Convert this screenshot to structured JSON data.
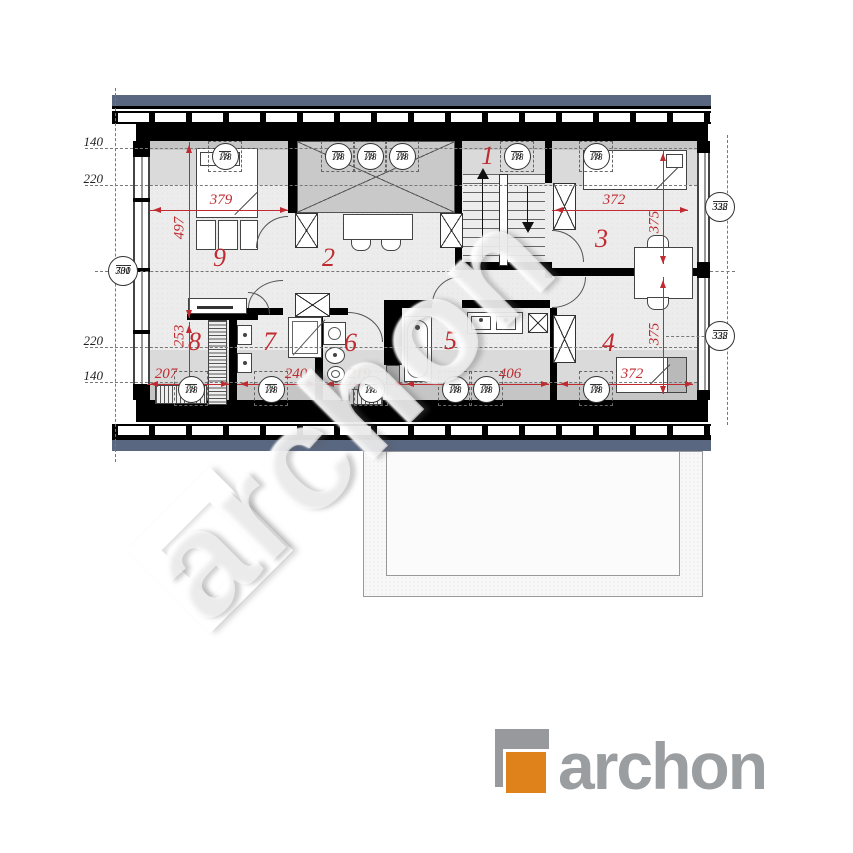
{
  "palette": {
    "roof_band": "#5a6780",
    "wall": "#000000",
    "floor": "#ececec",
    "zone_light": "#dadada",
    "zone_dark": "#c5c5c5",
    "void_fill": "#c9c9c9",
    "dim_red": "#bf2b30",
    "logo_gray": "#9b9ea1",
    "logo_orange": "#e0821c"
  },
  "plan": {
    "rooms": [
      {
        "n": "1",
        "x": 481,
        "y": 141
      },
      {
        "n": "2",
        "x": 322,
        "y": 243
      },
      {
        "n": "3",
        "x": 595,
        "y": 224
      },
      {
        "n": "4",
        "x": 602,
        "y": 328
      },
      {
        "n": "5",
        "x": 444,
        "y": 326
      },
      {
        "n": "6",
        "x": 344,
        "y": 328
      },
      {
        "n": "7",
        "x": 263,
        "y": 327
      },
      {
        "n": "8",
        "x": 188,
        "y": 327
      },
      {
        "n": "9",
        "x": 213,
        "y": 243
      }
    ],
    "dims_h": [
      {
        "t": "379",
        "x1": 150,
        "x2": 288,
        "y": 210,
        "tx": 221,
        "ty": 192
      },
      {
        "t": "372",
        "x1": 552,
        "x2": 688,
        "y": 210,
        "tx": 614,
        "ty": 192
      },
      {
        "t": "207",
        "x1": 147,
        "x2": 229,
        "y": 384,
        "tx": 166,
        "ty": 366
      },
      {
        "t": "240",
        "x1": 237,
        "x2": 315,
        "y": 384,
        "tx": 296,
        "ty": 366
      },
      {
        "t": "219",
        "x1": 323,
        "x2": 403,
        "y": 384,
        "tx": 359,
        "ty": 366
      },
      {
        "t": "406",
        "x1": 403,
        "x2": 549,
        "y": 384,
        "tx": 510,
        "ty": 366
      },
      {
        "t": "372",
        "x1": 557,
        "x2": 693,
        "y": 384,
        "tx": 632,
        "ty": 366
      }
    ],
    "dims_v": [
      {
        "t": "497",
        "x": 189,
        "y1": 142,
        "y2": 318,
        "tx": 180,
        "ty": 228
      },
      {
        "t": "253",
        "x": 189,
        "y1": 322,
        "y2": 398,
        "tx": 180,
        "ty": 336
      },
      {
        "t": "375",
        "x": 663,
        "y1": 150,
        "y2": 264,
        "tx": 655,
        "ty": 222
      },
      {
        "t": "375",
        "x": 663,
        "y1": 277,
        "y2": 394,
        "tx": 655,
        "ty": 334
      }
    ],
    "skylight": {
      "num": "78",
      "den": "118"
    },
    "skylights_top": [
      225,
      338,
      370,
      402,
      517,
      596
    ],
    "skylights_bottom": [
      191,
      271,
      371,
      455,
      486,
      596
    ],
    "level_markers": [
      {
        "num": "700",
        "den": "331",
        "cx": 123,
        "cy": 271
      },
      {
        "num": "338",
        "den": "322",
        "cx": 720,
        "cy": 207
      },
      {
        "num": "338",
        "den": "322",
        "cx": 720,
        "cy": 336
      }
    ],
    "side_labels": [
      {
        "t": "140",
        "x": 103,
        "y": 134
      },
      {
        "t": "220",
        "x": 103,
        "y": 171
      },
      {
        "t": "220",
        "x": 103,
        "y": 333
      },
      {
        "t": "140",
        "x": 103,
        "y": 368
      }
    ]
  },
  "logo": {
    "text": "archon"
  },
  "watermark": {
    "text": "archon"
  }
}
